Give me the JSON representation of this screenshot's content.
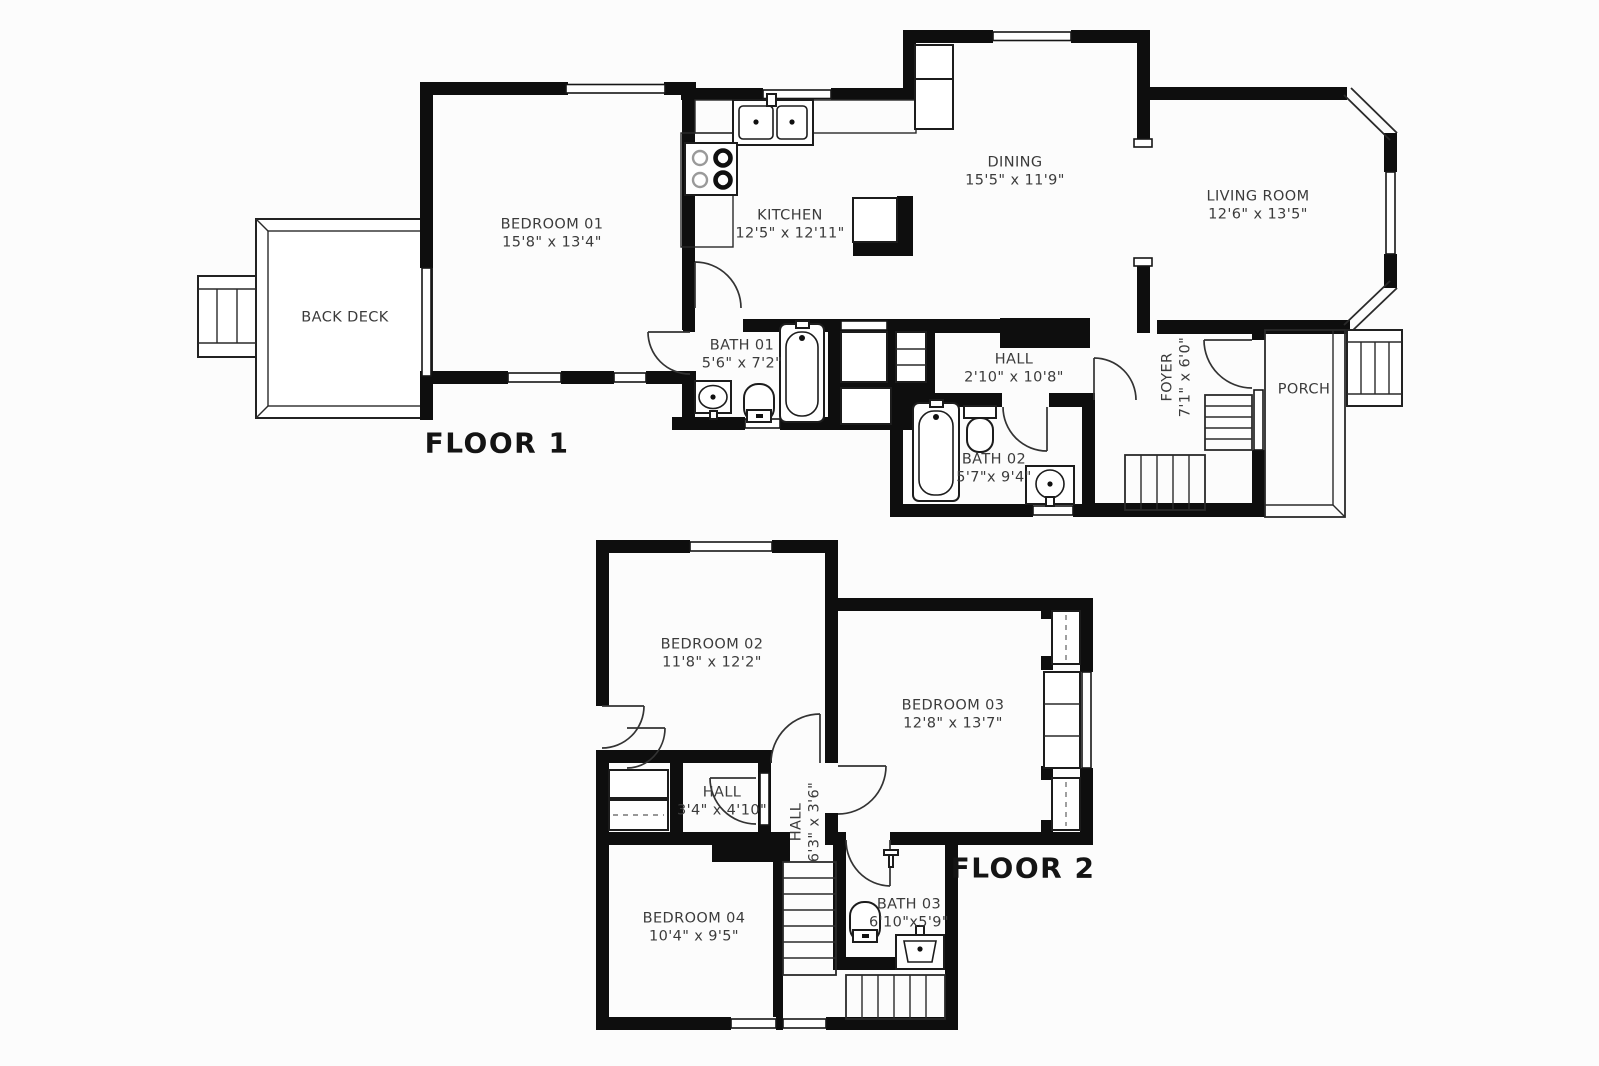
{
  "document": {
    "type": "floor-plan"
  },
  "colors": {
    "wall": "#0e0e0e",
    "line": "#2a2a2a",
    "text": "#3b3b3b",
    "background": "#fcfcfc"
  },
  "floor1": {
    "label": "FLOOR 1",
    "rooms": [
      {
        "id": "back-deck",
        "name": "BACK DECK",
        "dims": ""
      },
      {
        "id": "bedroom-01",
        "name": "BEDROOM 01",
        "dims": "15'8\" x 13'4\""
      },
      {
        "id": "kitchen",
        "name": "KITCHEN",
        "dims": "12'5\" x 12'11\""
      },
      {
        "id": "dining",
        "name": "DINING",
        "dims": "15'5\" x 11'9\""
      },
      {
        "id": "living-room",
        "name": "LIVING ROOM",
        "dims": "12'6\" x 13'5\""
      },
      {
        "id": "bath-01",
        "name": "BATH 01",
        "dims": "5'6\" x 7'2\""
      },
      {
        "id": "hall",
        "name": "HALL",
        "dims": "2'10\" x 10'8\""
      },
      {
        "id": "bath-02",
        "name": "BATH 02",
        "dims": "5'7\"x 9'4\""
      },
      {
        "id": "foyer",
        "name": "FOYER",
        "dims": "7'1\" x 6'0\""
      },
      {
        "id": "porch",
        "name": "PORCH",
        "dims": ""
      }
    ]
  },
  "floor2": {
    "label": "FLOOR 2",
    "rooms": [
      {
        "id": "bedroom-02",
        "name": "BEDROOM 02",
        "dims": "11'8\" x 12'2\""
      },
      {
        "id": "bedroom-03",
        "name": "BEDROOM 03",
        "dims": "12'8\" x 13'7\""
      },
      {
        "id": "hall-upper",
        "name": "HALL",
        "dims": "3'4\" x 4'10\""
      },
      {
        "id": "hall-stair",
        "name": "HALL",
        "dims": "6'3\" x 3'6\""
      },
      {
        "id": "bedroom-04",
        "name": "BEDROOM 04",
        "dims": "10'4\" x 9'5\""
      },
      {
        "id": "bath-03",
        "name": "BATH 03",
        "dims": "6'10\"x5'9\""
      }
    ]
  }
}
